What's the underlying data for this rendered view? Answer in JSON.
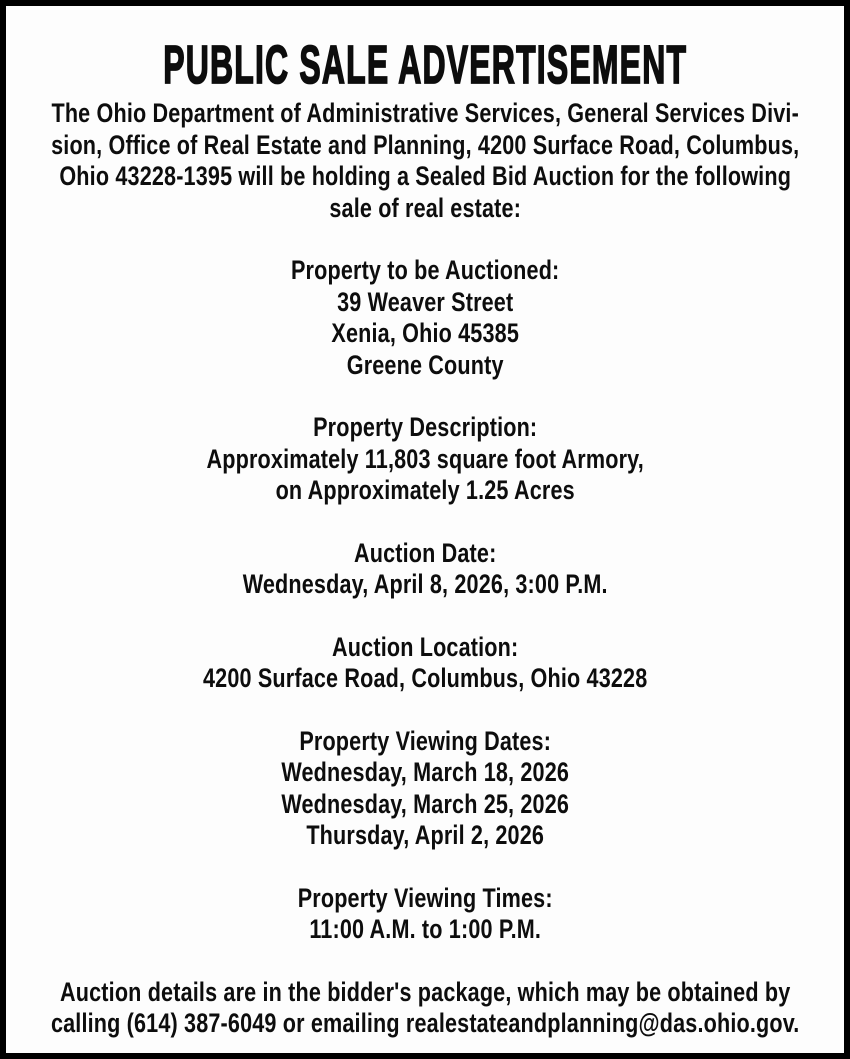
{
  "ad": {
    "title": "PUBLIC SALE ADVERTISEMENT",
    "intro_lines": [
      "The Ohio Department of Administrative Services, General Services Divi-",
      "sion, Office of Real Estate and Planning, 4200 Surface Road, Columbus,",
      "Ohio 43228-1395 will be holding a Sealed Bid Auction for the following",
      "sale of real estate:"
    ],
    "sections": [
      {
        "heading": "Property to be Auctioned:",
        "lines": [
          "39 Weaver Street",
          "Xenia, Ohio 45385",
          "Greene County"
        ]
      },
      {
        "heading": "Property Description:",
        "lines": [
          "Approximately 11,803 square foot Armory,",
          "on Approximately 1.25 Acres"
        ]
      },
      {
        "heading": "Auction Date:",
        "lines": [
          "Wednesday, April 8, 2026, 3:00 P.M."
        ]
      },
      {
        "heading": "Auction Location:",
        "lines": [
          "4200 Surface Road, Columbus, Ohio 43228"
        ]
      },
      {
        "heading": "Property Viewing Dates:",
        "lines": [
          "Wednesday, March 18, 2026",
          "Wednesday, March 25, 2026",
          "Thursday, April 2, 2026"
        ]
      },
      {
        "heading": "Property Viewing Times:",
        "lines": [
          "11:00 A.M. to 1:00 P.M."
        ]
      }
    ],
    "footer_lines": [
      "Auction details are in the bidder's package, which may be obtained by",
      "calling (614) 387-6049 or emailing realestateandplanning@das.ohio.gov."
    ],
    "contact": {
      "phone": "(614) 387-6049",
      "email": "realestateandplanning@das.ohio.gov"
    },
    "colors": {
      "text": "#0d0d0d",
      "background": "#fdfdfd",
      "border": "#000000"
    }
  }
}
